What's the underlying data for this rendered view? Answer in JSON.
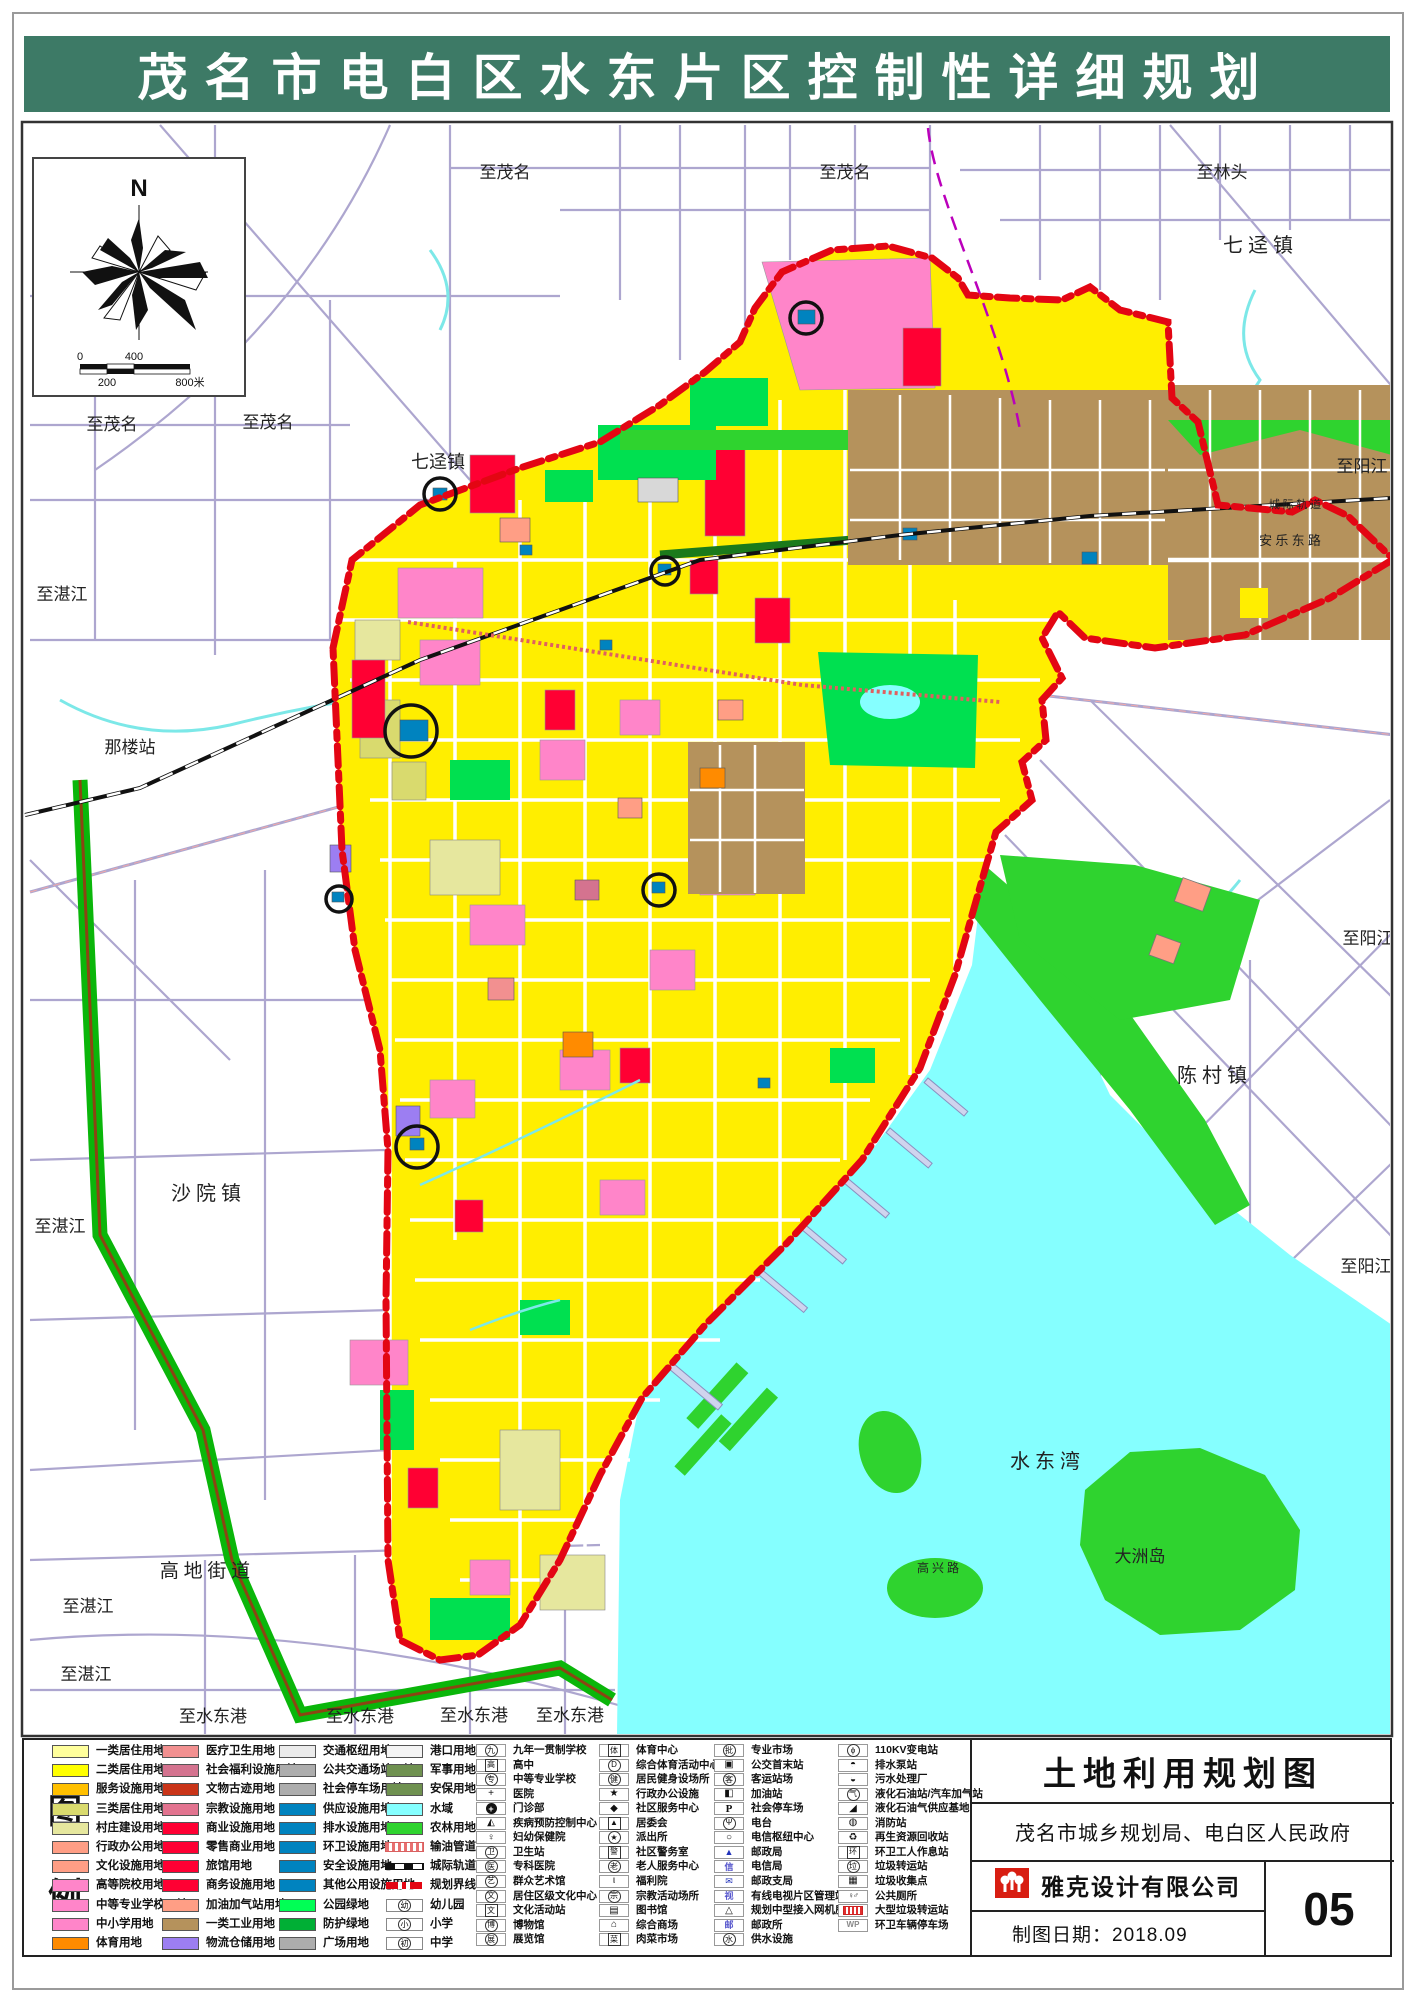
{
  "banner": {
    "title": "茂名市电白区水东片区控制性详细规划",
    "bg_color": "#3d7a66",
    "text_color": "#ffffff"
  },
  "colors": {
    "boundary_red": "#e30613",
    "base_yellow": "#ffee00",
    "bay_cyan": "#85ffff",
    "farm_green": "#2fd32f",
    "park_green": "#00e050",
    "industry_brown": "#b5925c"
  },
  "compass": {
    "north_label": "N",
    "scale_ticks": [
      "0",
      "200",
      "400",
      "800米"
    ]
  },
  "map": {
    "labels": [
      {
        "text": "至茂名",
        "x": 505,
        "y": 178,
        "size": 17
      },
      {
        "text": "至茂名",
        "x": 845,
        "y": 178,
        "size": 17
      },
      {
        "text": "至林头",
        "x": 1222,
        "y": 178,
        "size": 17
      },
      {
        "text": "七 迳 镇",
        "x": 1258,
        "y": 252,
        "size": 20
      },
      {
        "text": "至茂名",
        "x": 112,
        "y": 430,
        "size": 17
      },
      {
        "text": "至茂名",
        "x": 268,
        "y": 428,
        "size": 17
      },
      {
        "text": "七迳镇",
        "x": 438,
        "y": 468,
        "size": 18
      },
      {
        "text": "至湛江",
        "x": 62,
        "y": 600,
        "size": 17
      },
      {
        "text": "那楼站",
        "x": 130,
        "y": 753,
        "size": 17
      },
      {
        "text": "至阳江",
        "x": 1362,
        "y": 472,
        "size": 17
      },
      {
        "text": "至阳江",
        "x": 1368,
        "y": 944,
        "size": 17
      },
      {
        "text": "陈 村 镇",
        "x": 1212,
        "y": 1082,
        "size": 20
      },
      {
        "text": "沙 院 镇",
        "x": 206,
        "y": 1200,
        "size": 20
      },
      {
        "text": "至湛江",
        "x": 60,
        "y": 1232,
        "size": 17
      },
      {
        "text": "至阳江",
        "x": 1366,
        "y": 1272,
        "size": 17
      },
      {
        "text": "水  东  湾",
        "x": 1045,
        "y": 1468,
        "size": 20
      },
      {
        "text": "大洲岛",
        "x": 1140,
        "y": 1562,
        "size": 17
      },
      {
        "text": "高 地 街 道",
        "x": 205,
        "y": 1577,
        "size": 19
      },
      {
        "text": "至湛江",
        "x": 88,
        "y": 1612,
        "size": 17
      },
      {
        "text": "至湛江",
        "x": 86,
        "y": 1680,
        "size": 17
      },
      {
        "text": "至水东港",
        "x": 213,
        "y": 1722,
        "size": 17
      },
      {
        "text": "至水东港",
        "x": 360,
        "y": 1722,
        "size": 17
      },
      {
        "text": "至水东港",
        "x": 474,
        "y": 1721,
        "size": 17
      },
      {
        "text": "至水东港",
        "x": 570,
        "y": 1721,
        "size": 17
      }
    ],
    "road_labels": [
      {
        "text": "安 乐 东 路",
        "x": 1290,
        "y": 545,
        "size": 13
      },
      {
        "text": "城 际 轨 道",
        "x": 1295,
        "y": 508,
        "size": 11
      },
      {
        "text": "高 兴 路",
        "x": 938,
        "y": 1572,
        "size": 12
      }
    ]
  },
  "legend": {
    "heading_chars": [
      "图",
      "例"
    ],
    "land_use_columns": [
      [
        {
          "label": "一类居住用地",
          "color": "#ffff9c"
        },
        {
          "label": "二类居住用地",
          "color": "#ffff00"
        },
        {
          "label": "服务设施用地",
          "color": "#ffc000"
        },
        {
          "label": "三类居住用地",
          "color": "#d9da6e"
        },
        {
          "label": "村庄建设用地",
          "color": "#e6e79e"
        },
        {
          "label": "行政办公用地",
          "color": "#ff9e85"
        },
        {
          "label": "文化设施用地",
          "color": "#ff9e85"
        },
        {
          "label": "高等院校用地",
          "color": "#ff85c9"
        },
        {
          "label": "中等专业学校用地",
          "color": "#ff85c9"
        },
        {
          "label": "中小学用地",
          "color": "#ff85c9"
        },
        {
          "label": "体育用地",
          "color": "#ff8b00"
        }
      ],
      [
        {
          "label": "医疗卫生用地",
          "color": "#f29090"
        },
        {
          "label": "社会福利设施用地",
          "color": "#d4738f"
        },
        {
          "label": "文物古迹用地",
          "color": "#c93418"
        },
        {
          "label": "宗教设施用地",
          "color": "#e2738f"
        },
        {
          "label": "商业设施用地",
          "color": "#ff0033"
        },
        {
          "label": "零售商业用地",
          "color": "#ff0033"
        },
        {
          "label": "旅馆用地",
          "color": "#ff0033"
        },
        {
          "label": "商务设施用地",
          "color": "#ff0033"
        },
        {
          "label": "加油加气站用地",
          "color": "#ff9e85"
        },
        {
          "label": "一类工业用地",
          "color": "#b5925c"
        },
        {
          "label": "物流仓储用地",
          "color": "#9c7ef2"
        }
      ],
      [
        {
          "label": "交通枢纽用地",
          "color": "#ebebeb"
        },
        {
          "label": "公共交通场站用地",
          "color": "#adadad"
        },
        {
          "label": "社会停车场用地",
          "color": "#adadad"
        },
        {
          "label": "供应设施用地",
          "color": "#0083bf"
        },
        {
          "label": "排水设施用地",
          "color": "#0083bf"
        },
        {
          "label": "环卫设施用地",
          "color": "#0083bf"
        },
        {
          "label": "安全设施用地",
          "color": "#0083bf"
        },
        {
          "label": "其他公用设施用地",
          "color": "#0083bf"
        },
        {
          "label": "公园绿地",
          "color": "#00ff55"
        },
        {
          "label": "防护绿地",
          "color": "#00af35"
        },
        {
          "label": "广场用地",
          "color": "#adadad"
        }
      ],
      [
        {
          "label": "港口用地",
          "type": "color",
          "color": "#f4f4f4"
        },
        {
          "label": "军事用地",
          "type": "color",
          "color": "#6f9150"
        },
        {
          "label": "安保用地",
          "type": "color",
          "color": "#6f9150"
        },
        {
          "label": "水域",
          "type": "color",
          "color": "#85ffff"
        },
        {
          "label": "农林用地",
          "type": "color",
          "color": "#2fd32f"
        },
        {
          "label": "输油管道",
          "type": "pipeline"
        },
        {
          "label": "城际轨道",
          "type": "rail"
        },
        {
          "label": "规划界线",
          "type": "boundary"
        },
        {
          "label": "幼儿园",
          "type": "school",
          "glyph": "幼"
        },
        {
          "label": "小学",
          "type": "school",
          "glyph": "小"
        },
        {
          "label": "中学",
          "type": "school",
          "glyph": "初"
        }
      ]
    ],
    "symbol_columns": [
      [
        {
          "glyph": "九",
          "style": "c",
          "label": "九年一贯制学校"
        },
        {
          "glyph": "高",
          "style": "b",
          "label": "高中"
        },
        {
          "glyph": "专",
          "style": "c",
          "label": "中等专业学校"
        },
        {
          "glyph": "+",
          "style": "p",
          "label": "医院"
        },
        {
          "glyph": "+",
          "style": "d",
          "label": "门诊部"
        },
        {
          "glyph": "◭",
          "style": "p",
          "label": "疾病预防控制中心"
        },
        {
          "glyph": "♀",
          "style": "p",
          "label": "妇幼保健院"
        },
        {
          "glyph": "卫",
          "style": "c",
          "label": "卫生站"
        },
        {
          "glyph": "医",
          "style": "c",
          "label": "专科医院"
        },
        {
          "glyph": "艺",
          "style": "c",
          "label": "群众艺术馆"
        },
        {
          "glyph": "文",
          "style": "c",
          "label": "居住区级文化中心"
        },
        {
          "glyph": "文",
          "style": "b",
          "label": "文化活动站"
        },
        {
          "glyph": "博",
          "style": "c",
          "label": "博物馆"
        },
        {
          "glyph": "展",
          "style": "c",
          "label": "展览馆"
        }
      ],
      [
        {
          "glyph": "体",
          "style": "b",
          "label": "体育中心"
        },
        {
          "glyph": "D",
          "style": "c",
          "label": "综合体育活动中心"
        },
        {
          "glyph": "健",
          "style": "c",
          "label": "居民健身设场所"
        },
        {
          "glyph": "★",
          "style": "p",
          "label": "行政办公设施"
        },
        {
          "glyph": "◆",
          "style": "p",
          "label": "社区服务中心"
        },
        {
          "glyph": "▲",
          "style": "b",
          "label": "居委会"
        },
        {
          "glyph": "★",
          "style": "c",
          "label": "派出所"
        },
        {
          "glyph": "警",
          "style": "b",
          "label": "社区警务室"
        },
        {
          "glyph": "老",
          "style": "c",
          "label": "老人服务中心"
        },
        {
          "glyph": "ι",
          "style": "p",
          "label": "福利院"
        },
        {
          "glyph": "宗",
          "style": "c",
          "label": "宗教活动场所"
        },
        {
          "glyph": "▤",
          "style": "p",
          "label": "图书馆"
        },
        {
          "glyph": "⌂",
          "style": "p",
          "label": "综合商场"
        },
        {
          "glyph": "菜",
          "style": "b",
          "label": "肉菜市场"
        }
      ],
      [
        {
          "glyph": "批",
          "style": "c",
          "label": "专业市场"
        },
        {
          "glyph": "▣",
          "style": "p",
          "label": "公交首末站"
        },
        {
          "glyph": "客",
          "style": "c",
          "label": "客运站场"
        },
        {
          "glyph": "◧",
          "style": "p",
          "label": "加油站"
        },
        {
          "glyph": "P",
          "style": "serif",
          "label": "社会停车场"
        },
        {
          "glyph": "Ψ",
          "style": "c",
          "label": "电台"
        },
        {
          "glyph": "○",
          "style": "p",
          "label": "电信枢纽中心"
        },
        {
          "glyph": "▲",
          "style": "bb",
          "label": "邮政局"
        },
        {
          "glyph": "信",
          "style": "bt",
          "label": "电信局"
        },
        {
          "glyph": "✉",
          "style": "bb",
          "label": "邮政支局"
        },
        {
          "glyph": "视",
          "style": "bt",
          "label": "有线电视片区管理站"
        },
        {
          "glyph": "△",
          "style": "p",
          "label": "规划中型接入网机房"
        },
        {
          "glyph": "邮",
          "style": "bt",
          "label": "邮政所"
        },
        {
          "glyph": "水",
          "style": "c",
          "label": "供水设施"
        }
      ],
      [
        {
          "glyph": "ϕ",
          "style": "c",
          "label": "110KV变电站"
        },
        {
          "glyph": "◓",
          "style": "p",
          "label": "排水泵站"
        },
        {
          "glyph": "◒",
          "style": "p",
          "label": "污水处理厂"
        },
        {
          "glyph": "气",
          "style": "c",
          "label": "液化石油站/汽车加气站"
        },
        {
          "glyph": "◢",
          "style": "p",
          "label": "液化石油气供应基地"
        },
        {
          "glyph": "◍",
          "style": "p",
          "label": "消防站"
        },
        {
          "glyph": "♻",
          "style": "p",
          "label": "再生资源回收站"
        },
        {
          "glyph": "环",
          "style": "b",
          "label": "环卫工人作息站"
        },
        {
          "glyph": "垃",
          "style": "c",
          "label": "垃圾转运站"
        },
        {
          "glyph": "▦",
          "style": "p",
          "label": "垃圾收集点"
        },
        {
          "glyph": "♀♂",
          "style": "small",
          "label": "公共厕所"
        },
        {
          "glyph": "",
          "style": "rb",
          "label": "大型垃圾转运站"
        },
        {
          "glyph": "WP",
          "style": "grey",
          "label": "环卫车辆停车场"
        }
      ]
    ]
  },
  "titleblock": {
    "map_title": "土地利用规划图",
    "authority": "茂名市城乡规划局、电白区人民政府",
    "company": "雅克设计有限公司",
    "date_line": "制图日期：2018.09",
    "sheet_number": "05"
  }
}
